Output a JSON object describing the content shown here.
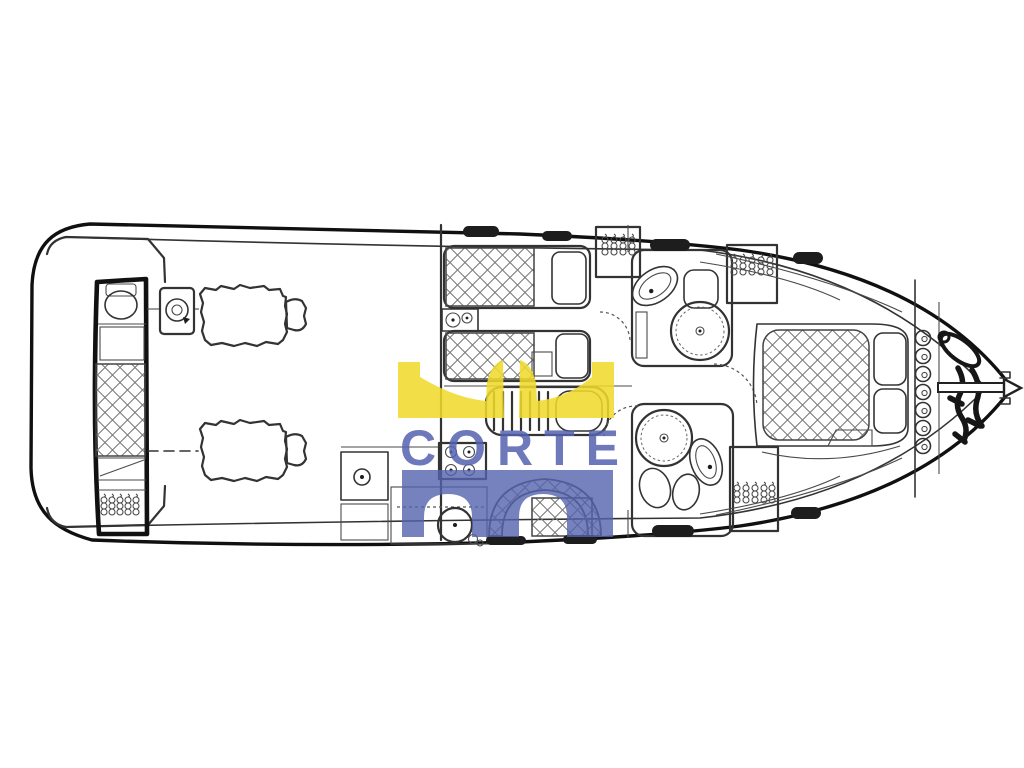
{
  "watermark": {
    "text": "CORTE",
    "crown_color": "#f0d92a",
    "blue_color": "#5363ad"
  },
  "diagram": {
    "type": "yacht-deck-plan",
    "orientation": "bow-right-stern-left",
    "line_color": "#2f2f2f",
    "background_color": "#ffffff",
    "features": [
      "hull-outline",
      "swim-platform-steps",
      "aft-crew-cabin",
      "crew-toilet",
      "crew-berth",
      "crew-hanging-locker",
      "generator",
      "engine-port",
      "engine-starboard",
      "propeller-shaft-line",
      "engine-room-bulkhead",
      "guest-cabin-twin-berths",
      "guest-nightstand",
      "companionway-steps",
      "galley-stove",
      "galley-sink",
      "galley-cabinet",
      "dinette-curved-seat",
      "upper-head-sink",
      "upper-head-toilet",
      "upper-head-shower",
      "lower-head-shower",
      "lower-head-sink",
      "lower-head-toilet",
      "hanging-lockers",
      "master-cabin-double-berth",
      "master-pillows",
      "deck-hatches",
      "anchor-chain-links",
      "anchor-and-rode",
      "bow-roller"
    ]
  }
}
